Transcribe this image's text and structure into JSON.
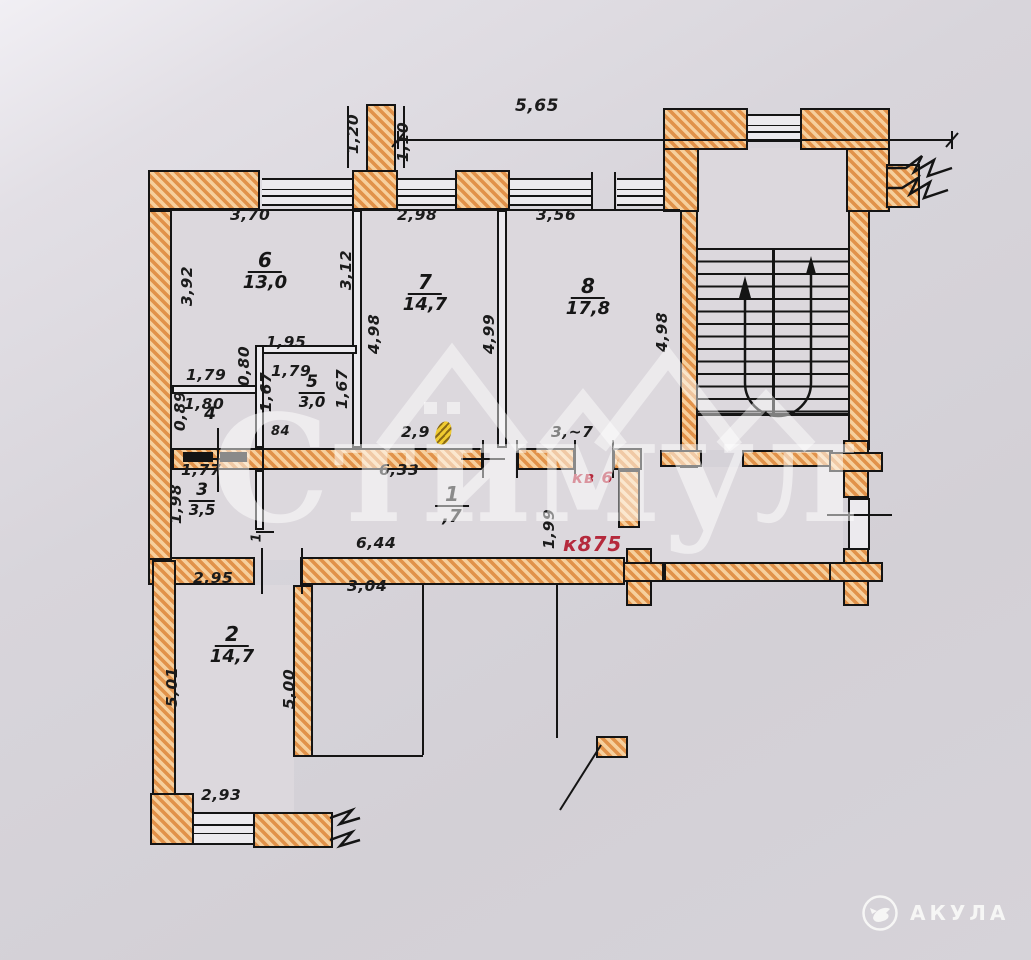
{
  "rooms": [
    {
      "num": "6",
      "area": "13,0"
    },
    {
      "num": "7",
      "area": "14,7"
    },
    {
      "num": "8",
      "area": "17,8"
    },
    {
      "num": "5",
      "area": "3,0"
    },
    {
      "num": "4",
      "area": ""
    },
    {
      "num": "3",
      "area": "3,5"
    },
    {
      "num": "1",
      "area": ",7"
    },
    {
      "num": "2",
      "area": "14,7"
    }
  ],
  "dims": [
    {
      "t": "5,65"
    },
    {
      "t": "1,20"
    },
    {
      "t": "1,10"
    },
    {
      "t": "3,70"
    },
    {
      "t": "2,98"
    },
    {
      "t": "3,56"
    },
    {
      "t": "3,92"
    },
    {
      "t": "3,12"
    },
    {
      "t": "4,98"
    },
    {
      "t": "4,99"
    },
    {
      "t": "4,98"
    },
    {
      "t": "1,95"
    },
    {
      "t": "1,79"
    },
    {
      "t": "0,80"
    },
    {
      "t": "1,79"
    },
    {
      "t": "1,67"
    },
    {
      "t": "1,67"
    },
    {
      "t": "0,89"
    },
    {
      "t": "1,80"
    },
    {
      "t": "1,77"
    },
    {
      "t": "84"
    },
    {
      "t": "2,9"
    },
    {
      "t": "3,~7"
    },
    {
      "t": "6,33"
    },
    {
      "t": "6,44"
    },
    {
      "t": "1,99"
    },
    {
      "t": "1,98"
    },
    {
      "t": "1"
    },
    {
      "t": "2,95"
    },
    {
      "t": "3,04"
    },
    {
      "t": "5,01"
    },
    {
      "t": "5,00"
    },
    {
      "t": "2,93"
    }
  ],
  "annotations": {
    "apartment": "кв 6",
    "cadastral": "к875"
  },
  "watermark": {
    "text": "Стимул"
  },
  "logo": {
    "brand": "АКУЛА"
  },
  "colors": {
    "hatch_dark": "#e1924a",
    "hatch_light": "#f6cf9d",
    "line": "#141414",
    "red": "#b5293c",
    "paper": "#d7d4da"
  }
}
